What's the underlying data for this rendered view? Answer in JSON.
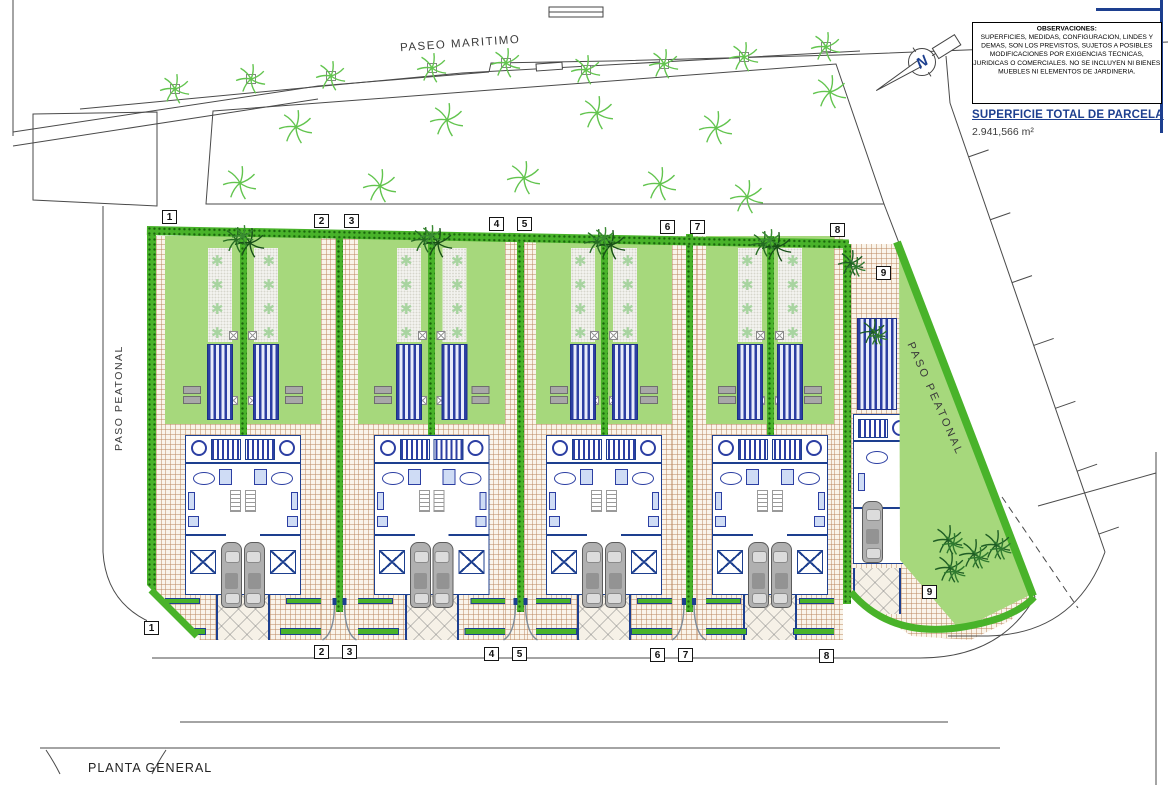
{
  "title_block": {
    "observaciones": {
      "title": "OBSERVACIONES:",
      "body": "SUPERFICIES, MEDIDAS, CONFIGURACION, LINDES Y DEMAS, SON LOS PREVISTOS, SUJETOS A POSIBLES MODIFICACIONES POR EXIGENCIAS TECNICAS, JURIDICAS O COMERCIALES. NO SE INCLUYEN NI BIENES MUEBLES NI ELEMENTOS DE JARDINERIA."
    },
    "superficie": {
      "label": "SUPERFICIE TOTAL DE PARCELA",
      "value": "2.941,566 m²"
    }
  },
  "labels": {
    "paseo_maritimo": "PASEO MARITIMO",
    "paso_peatonal_left": "PASO PEATONAL",
    "paso_peatonal_right": "PASO PEATONAL",
    "planta_general": "PLANTA GENERAL",
    "compass_north": "N"
  },
  "plot_markers": {
    "top": [
      "1",
      "2",
      "3",
      "4",
      "5",
      "6",
      "7",
      "8"
    ],
    "bottom": [
      "1",
      "2",
      "3",
      "4",
      "5",
      "6",
      "7",
      "8"
    ],
    "corner": [
      "9",
      "9"
    ]
  },
  "icons": {
    "plant_glyph": "✱"
  },
  "colors": {
    "navy": "#1d3f8f",
    "poolblue": "#2c3fa3",
    "lawn": "#a6d87c",
    "hedge": "#49b32a",
    "road_line": "#4a4a4a",
    "palm_light": "#62c44e",
    "palm_dark": "#1e5c24"
  }
}
